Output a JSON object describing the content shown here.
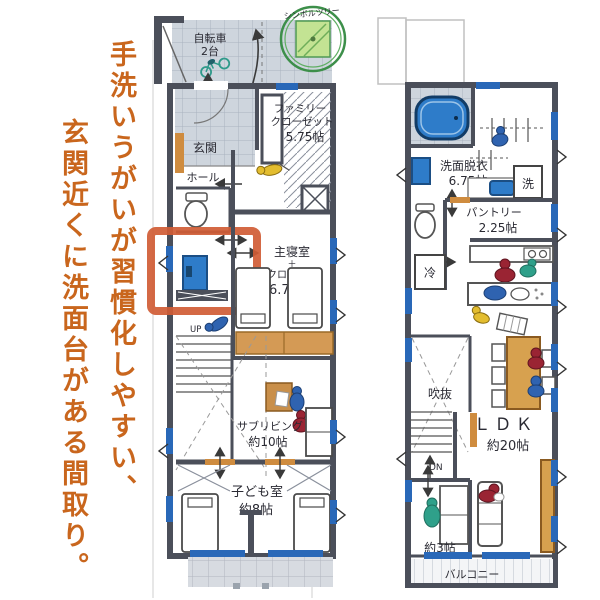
{
  "caption": {
    "line1": "手洗いうがいが習慣化しやすい、",
    "line2": "玄関近くに洗面台がある間取り。",
    "text_color": "#c9661d"
  },
  "plan1": {
    "bicycle": [
      "自転車",
      "2台"
    ],
    "symbol_tree": "シンボルツリー",
    "entrance": "玄関",
    "family_closet": [
      "ファミリー",
      "クローゼット",
      "5.75帖"
    ],
    "hall": "ホール",
    "up": "UP",
    "master_bedroom": [
      "主寝室",
      "＋",
      "クロゼット",
      "6.75帖"
    ],
    "sub_living": [
      "サブリビング",
      "約10帖"
    ],
    "kids_room": [
      "子ども室",
      "約8帖"
    ]
  },
  "plan2": {
    "washroom": [
      "洗面脱衣",
      "6.75帖"
    ],
    "laundry": "洗",
    "pantry": [
      "パントリー",
      "2.25帖"
    ],
    "fridge": "冷",
    "void": "吹抜",
    "down": "DN",
    "ldk": [
      "ＬＤＫ",
      "約20帖"
    ],
    "tatami": "約3帖",
    "balcony": "バルコニー"
  },
  "colors": {
    "highlight_box": "#d05c35",
    "wall": "#4b4f5a",
    "fixture_blue": "#2e7cc9",
    "window_blue": "#2968b8",
    "wood": "#d7a14f",
    "tree_green": "#3d8f4a",
    "tile": "#ced5dd"
  }
}
